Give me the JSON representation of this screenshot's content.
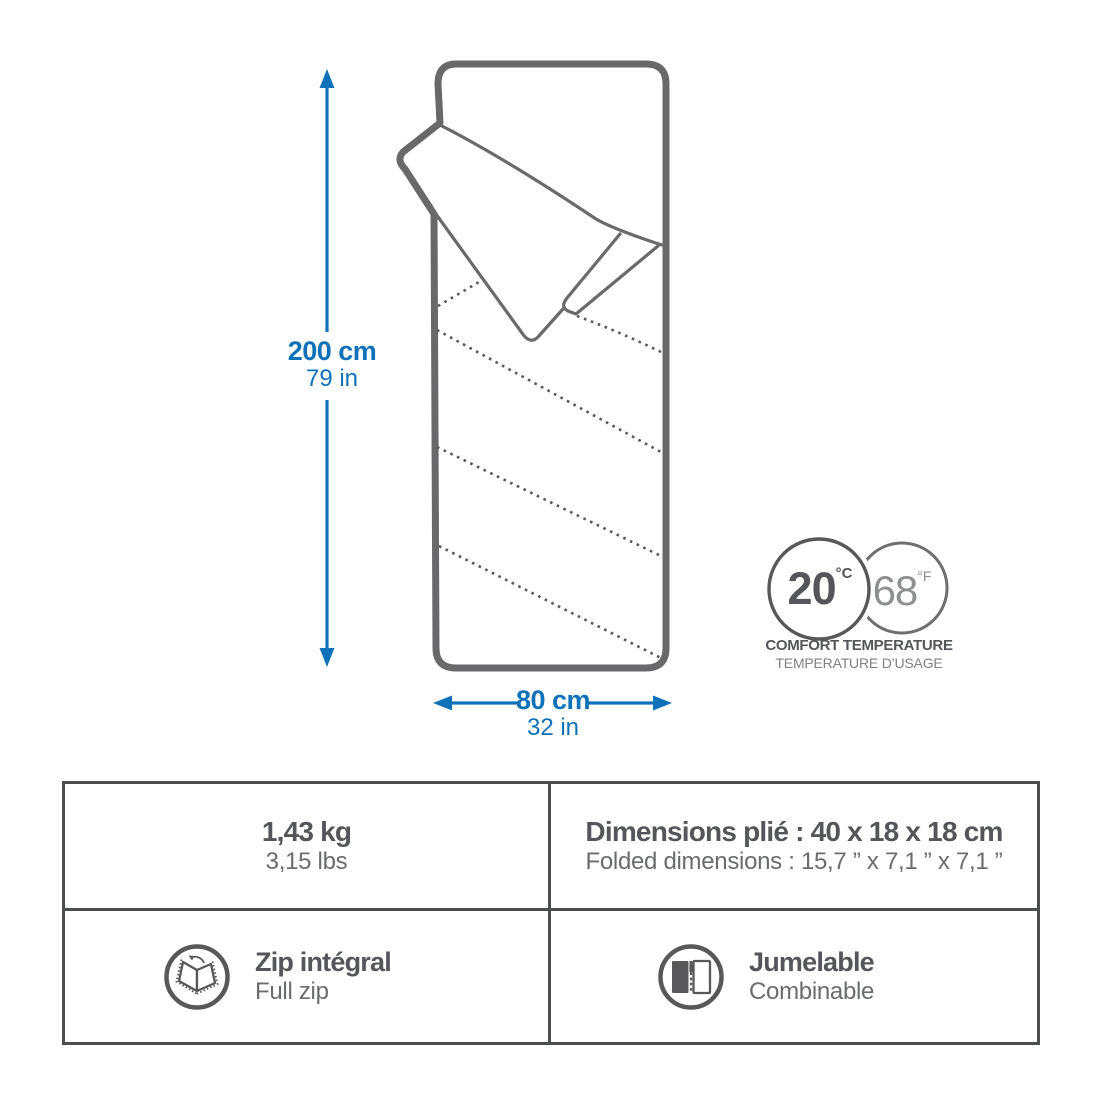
{
  "colors": {
    "accent_blue": "#0f72b8",
    "outline_gray": "#69696c",
    "text_dark": "#55565a",
    "text_mid": "#6b6c6e",
    "text_light": "#8e8f91"
  },
  "dimensions": {
    "height": {
      "metric": "200 cm",
      "imperial": "79 in"
    },
    "width": {
      "metric": "80 cm",
      "imperial": "32 in"
    }
  },
  "comfort_temperature": {
    "celsius": {
      "value": "20",
      "unit": "°C"
    },
    "fahrenheit": {
      "value": "68",
      "unit": "°F"
    },
    "label_en": "COMFORT TEMPERATURE",
    "label_fr": "TEMPERATURE D’USAGE"
  },
  "spec_table": {
    "weight": {
      "primary": "1,43 kg",
      "secondary": "3,15 lbs"
    },
    "folded": {
      "primary": "Dimensions plié : 40 x 18 x 18 cm",
      "secondary": "Folded dimensions : 15,7 ” x 7,1 ” x 7,1 ”"
    },
    "zip": {
      "icon": "open-sleeping-bag-full-zip-icon",
      "primary": "Zip intégral",
      "secondary": "Full zip"
    },
    "pairable": {
      "icon": "two-bags-zipped-together-icon",
      "primary": "Jumelable",
      "secondary": "Combinable"
    }
  }
}
